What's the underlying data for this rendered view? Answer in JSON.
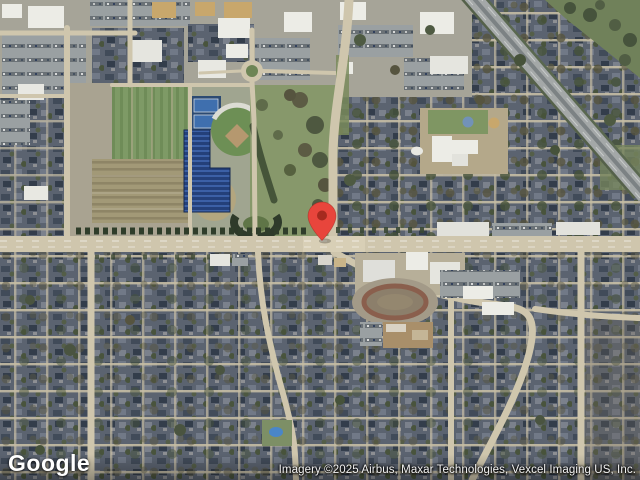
{
  "map": {
    "view_type": "satellite",
    "logo_text": "Google",
    "attribution_text": "Imagery ©2025 Airbus, Maxar Technologies, Vexcel Imaging US, Inc.",
    "marker": {
      "label": "location-pin",
      "color": "#E8453C",
      "dot_color": "#A62A1F"
    },
    "colors": {
      "road": "#CFC6AD",
      "road_light": "#D8CFB6",
      "urban_base": "#A6A498",
      "park_green": "#87986B",
      "field_green": "#7E9A66",
      "field_brown": "#A29977",
      "solar_panels": "#24407A",
      "highway": "#A4A8A8",
      "tree_dark": "#3C4A33",
      "pool_blue": "#4A86C8",
      "building_white": "#ECECE6",
      "building_tan": "#C8A76C"
    }
  }
}
